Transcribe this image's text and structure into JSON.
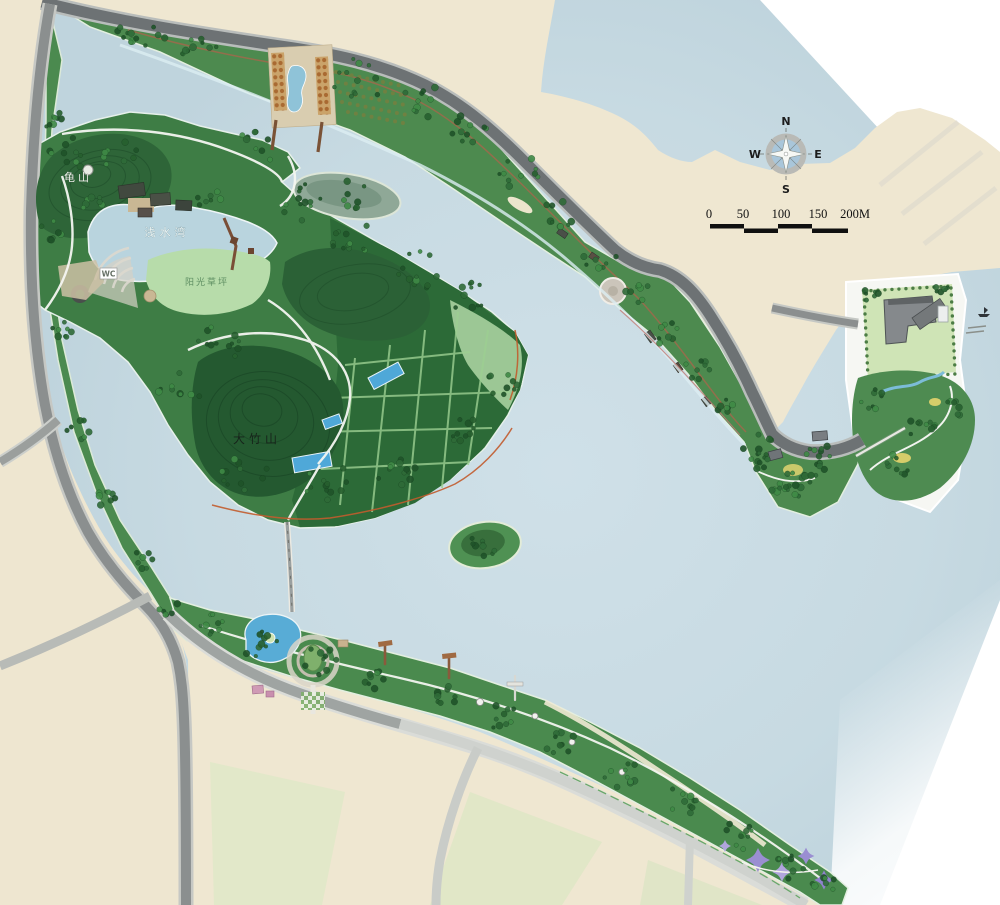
{
  "map": {
    "labels": {
      "hill_nw": "龟山",
      "bay": "浅水湾",
      "lawn": "阳光草坪",
      "hill_central": "大竹山",
      "wc": "WC"
    },
    "compass": {
      "north": "N",
      "east": "E",
      "south": "S",
      "west": "W"
    },
    "scale_bar": {
      "labels": [
        "0",
        "50",
        "100",
        "150",
        "200M"
      ]
    },
    "colors": {
      "paper": "#efe7d1",
      "lake": "#c7dae2",
      "park_green": "#46854b",
      "hill_green": "#2a5d34",
      "lawn_green": "#b7dcaa",
      "road_dark": "#6d7274",
      "road_light": "#cfd2ce",
      "pond_blue": "#55abd6",
      "bosque_orange": "#b5763c",
      "flower_purple": "#9a8ed2"
    }
  }
}
